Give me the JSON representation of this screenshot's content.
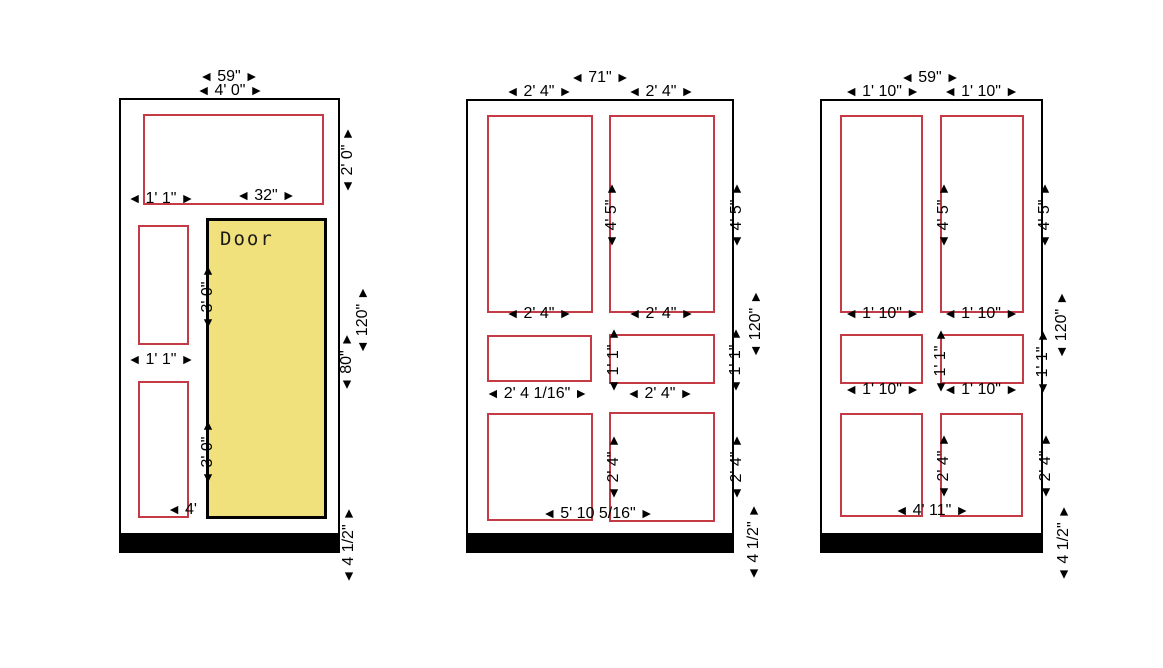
{
  "colors": {
    "opening_outline": "#c43a45",
    "door_fill": "#f0e17c",
    "wall_outline": "#000000",
    "baseboard_fill": "#000000"
  },
  "panels": [
    {
      "door_label": "Door",
      "dims": {
        "width_in": "59\"",
        "width_ft": "4' 0\"",
        "rectA_offset": "1' 1\"",
        "rectA_width": "32\"",
        "rectB_width": "1' 1\"",
        "rectC_width": "4'",
        "rectA_height": "2' 0\"",
        "door_upper_height": "3' 0\"",
        "door_lower_height": "3' 0\"",
        "door_height": "80\"",
        "wall_height": "120\"",
        "base_height": "4 1/2\""
      }
    },
    {
      "dims": {
        "width_in": "71\"",
        "top_left": "2' 4\"",
        "top_right": "2' 4\"",
        "tall_left_bottom": "2' 4\"",
        "tall_right_bottom": "2' 4\"",
        "mid_left": "2' 4 1/16\"",
        "mid_right": "2' 4\"",
        "bottom_span": "5' 10 5/16\"",
        "tall_height_mid": "4' 5\"",
        "tall_height_right": "4' 5\"",
        "mid_height_mid": "1' 1\"",
        "mid_height_right": "1' 1\"",
        "wall_height": "120\"",
        "bottom_height_mid": "2' 4\"",
        "bottom_height_right": "2' 4\"",
        "base_height": "4 1/2\""
      }
    },
    {
      "dims": {
        "width_in": "59\"",
        "top_left": "1' 10\"",
        "top_right": "1' 10\"",
        "tall_left_bottom": "1' 10\"",
        "tall_right_bottom": "1' 10\"",
        "mid_left": "1' 10\"",
        "mid_right": "1' 10\"",
        "bottom_span": "4' 11\"",
        "tall_height_mid": "4' 5\"",
        "tall_height_right": "4' 5\"",
        "mid_height_mid": "1' 1\"",
        "mid_height_right": "1' 1\"",
        "wall_height": "120\"",
        "bottom_height_mid": "2' 4\"",
        "bottom_height_right": "2' 4\"",
        "base_height": "4 1/2\""
      }
    }
  ]
}
